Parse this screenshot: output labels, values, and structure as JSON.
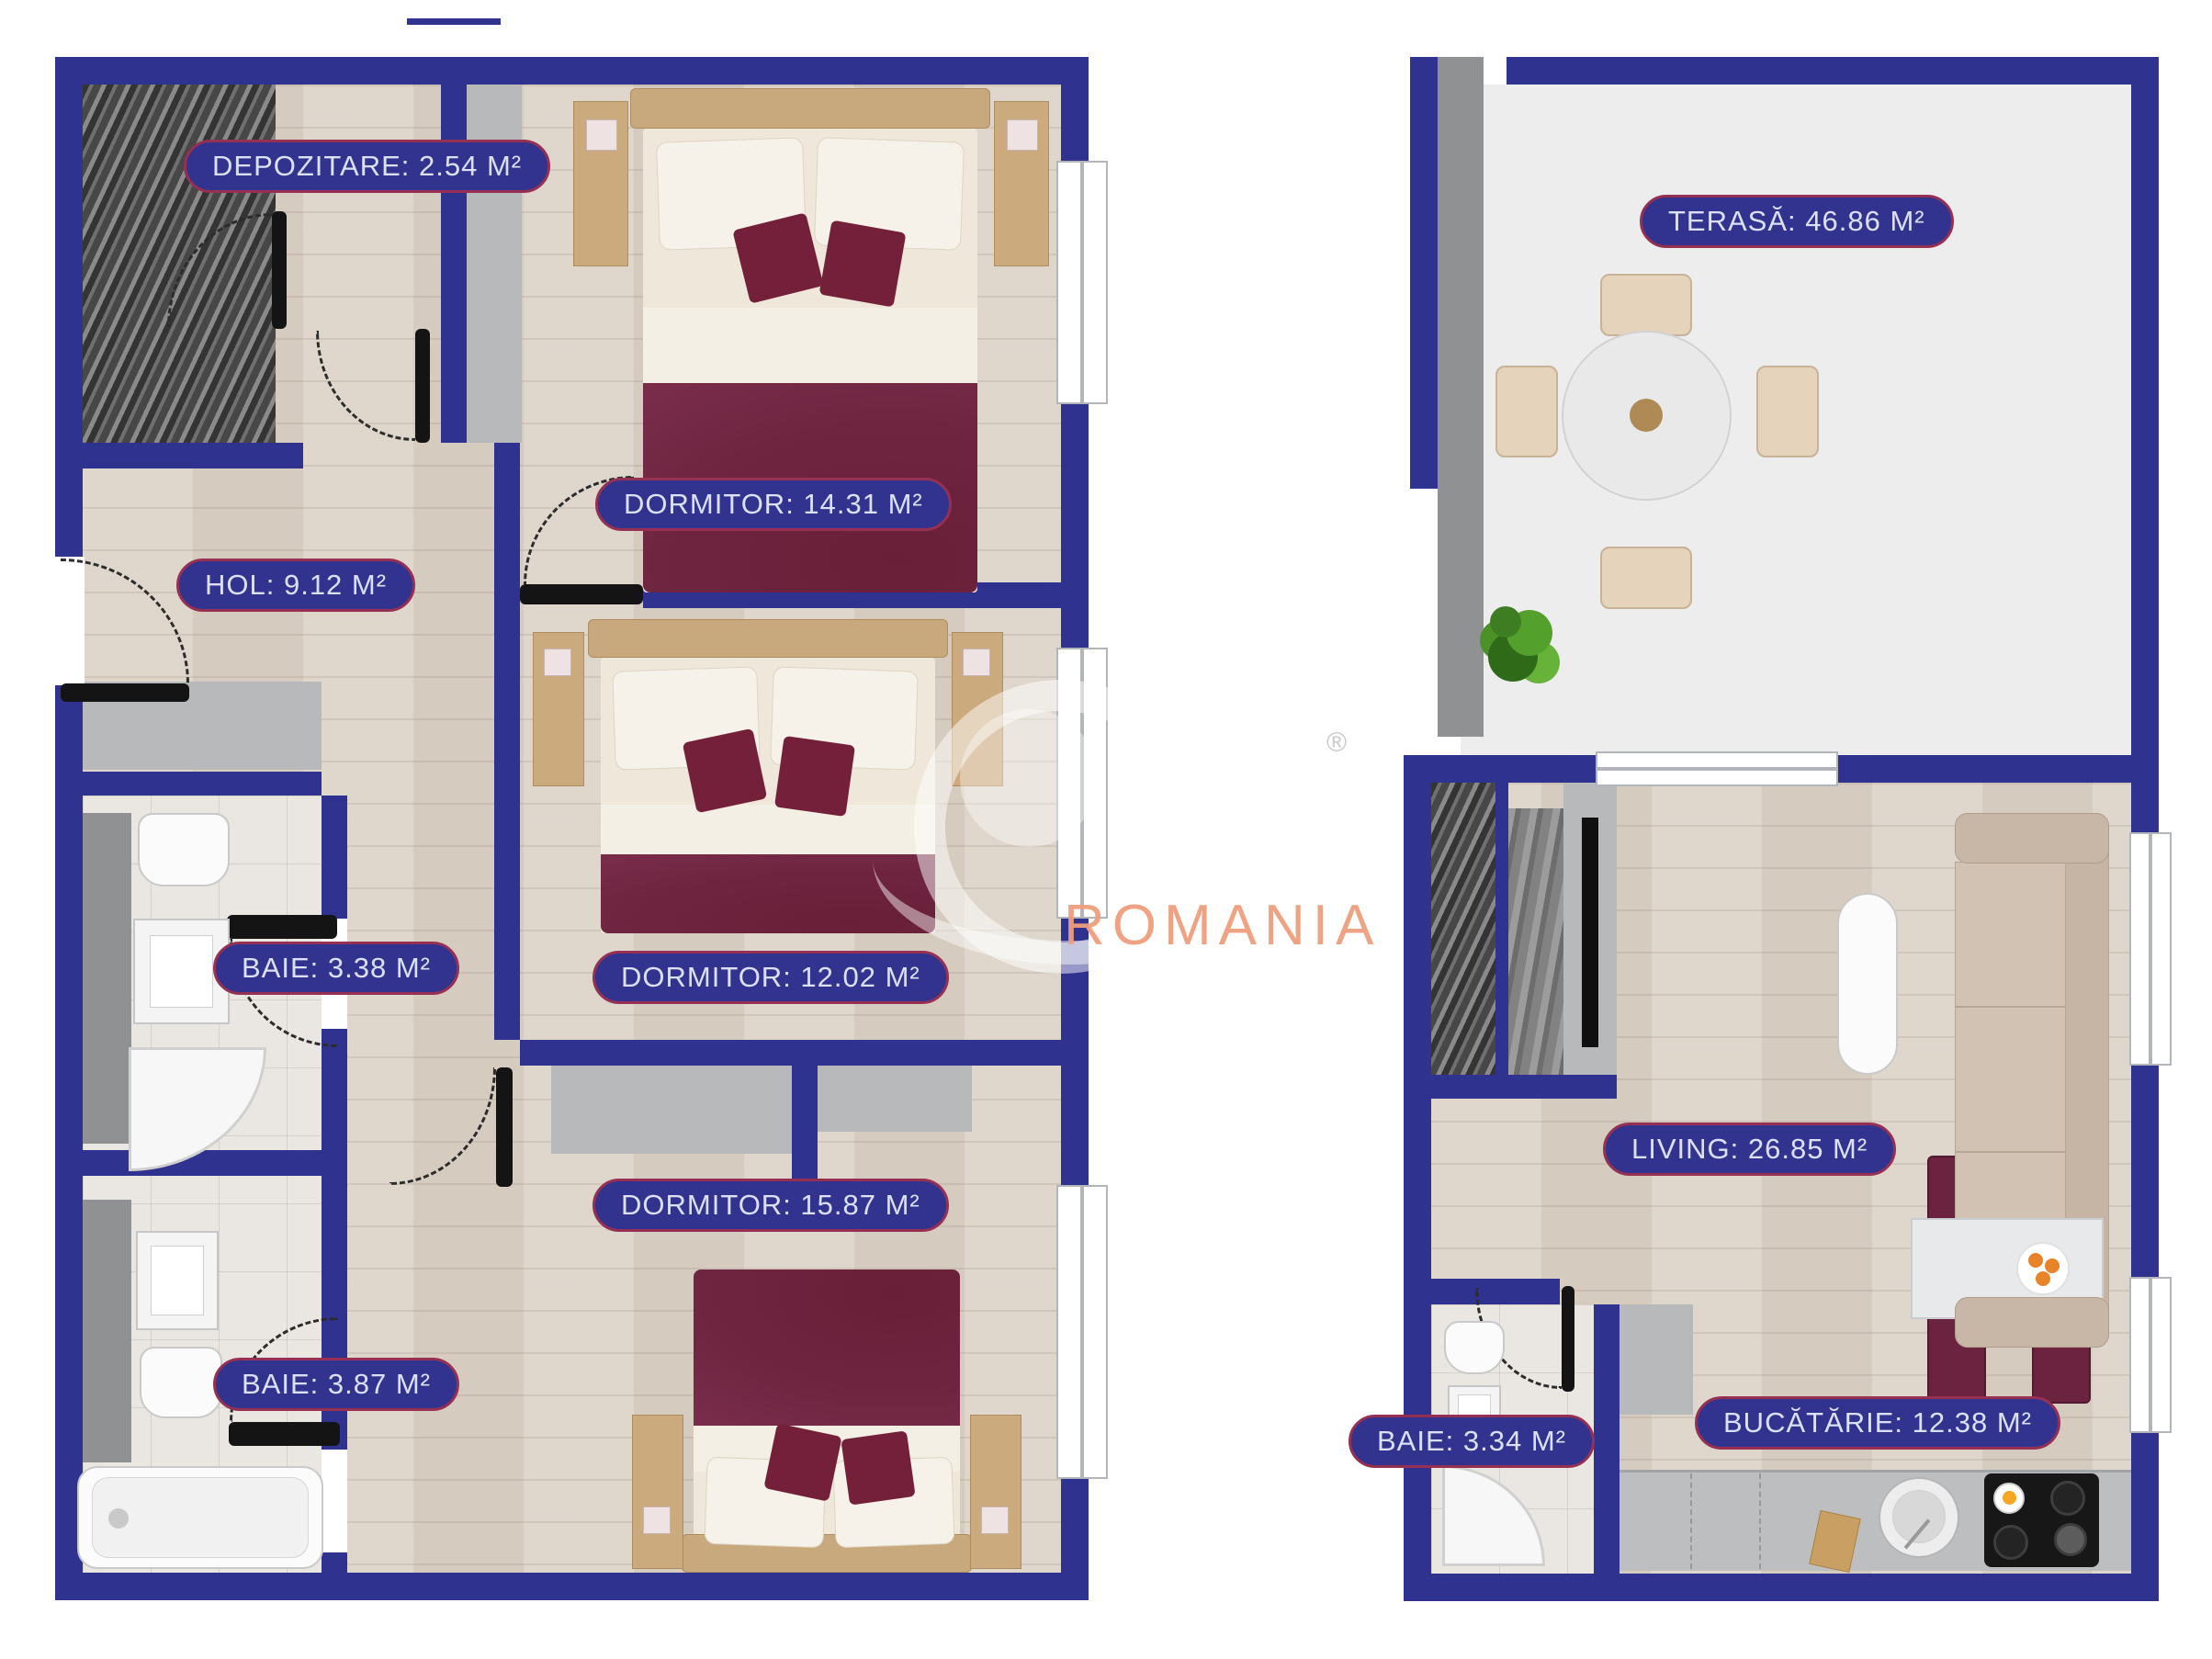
{
  "watermark": {
    "text": "ROMANIA",
    "registered": "®"
  },
  "rooms": [
    {
      "id": "depozitare",
      "name": "DEPOZITARE",
      "area_m2": 2.54,
      "label": "DEPOZITARE: 2.54 M²"
    },
    {
      "id": "dormitor-1",
      "name": "DORMITOR",
      "area_m2": 14.31,
      "label": "DORMITOR: 14.31 M²"
    },
    {
      "id": "hol",
      "name": "HOL",
      "area_m2": 9.12,
      "label": "HOL: 9.12 M²"
    },
    {
      "id": "baie-1",
      "name": "BAIE",
      "area_m2": 3.38,
      "label": "BAIE: 3.38 M²"
    },
    {
      "id": "dormitor-2",
      "name": "DORMITOR",
      "area_m2": 12.02,
      "label": "DORMITOR: 12.02 M²"
    },
    {
      "id": "baie-2",
      "name": "BAIE",
      "area_m2": 3.87,
      "label": "BAIE: 3.87 M²"
    },
    {
      "id": "dormitor-3",
      "name": "DORMITOR",
      "area_m2": 15.87,
      "label": "DORMITOR: 15.87 M²"
    },
    {
      "id": "terasa",
      "name": "TERASĂ",
      "area_m2": 46.86,
      "label": "TERASĂ: 46.86 M²"
    },
    {
      "id": "living",
      "name": "LIVING",
      "area_m2": 26.85,
      "label": "LIVING: 26.85 M²"
    },
    {
      "id": "baie-3",
      "name": "BAIE",
      "area_m2": 3.34,
      "label": "BAIE: 3.34 M²"
    },
    {
      "id": "bucatarie",
      "name": "BUCĂTĂRIE",
      "area_m2": 12.38,
      "label": "BUCĂTĂRIE: 12.38 M²"
    }
  ],
  "colors": {
    "wall": "#30328f",
    "label_background": "#32338f",
    "label_border": "#963052",
    "label_text": "#dce0f5",
    "wood_floor": "#dbd2c6",
    "tile_floor": "#eae7e2",
    "terrace_floor": "#ededee",
    "bed_blanket": "#6f2540",
    "watermark_text": "#ee9e7c"
  }
}
